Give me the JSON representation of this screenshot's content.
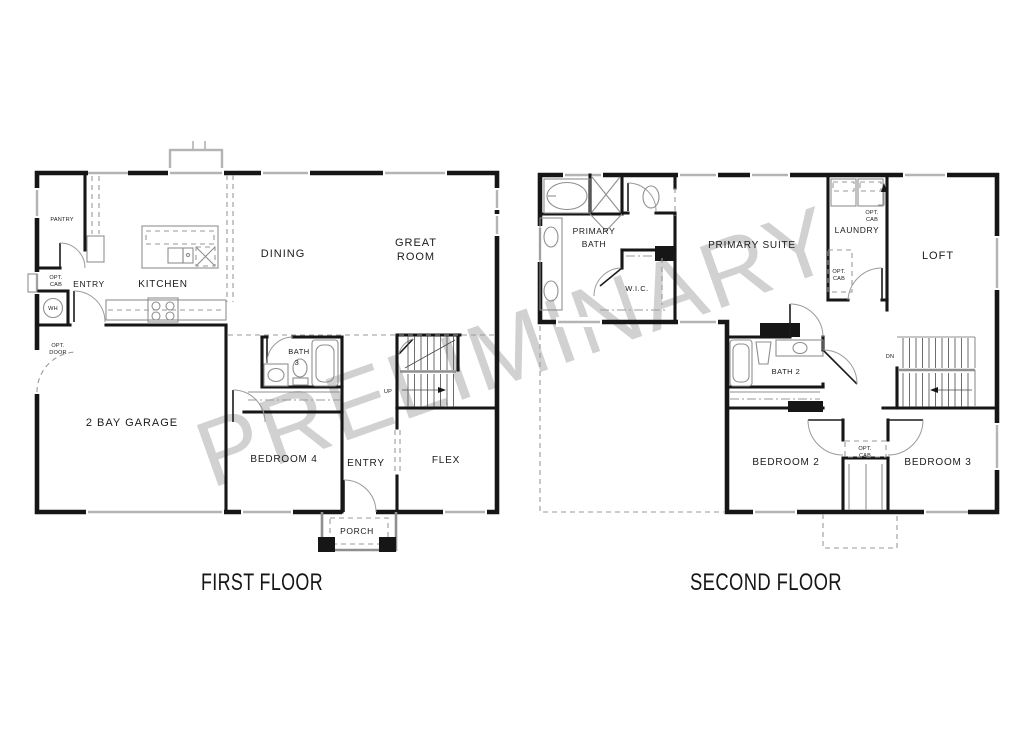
{
  "watermark": "PRELIMINARY",
  "colors": {
    "background": "#ffffff",
    "wall": "#161616",
    "fixture": "#8f8f8f",
    "dashed": "#9a9a9a",
    "window_sill": "#b4b4b4",
    "watermark": "#c9c9c9"
  },
  "first_floor": {
    "title": "FIRST FLOOR",
    "labels": {
      "pantry": "PANTRY",
      "opt_cab_line1": "OPT.",
      "opt_cab_line2": "CAB",
      "entry_rear": "ENTRY",
      "wh": "WH",
      "kitchen": "KITCHEN",
      "dining": "DINING",
      "great_room_line1": "GREAT",
      "great_room_line2": "ROOM",
      "opt_door_line1": "OPT.",
      "opt_door_line2": "DOOR",
      "garage": "2 BAY GARAGE",
      "bath3_line1": "BATH",
      "bath3_line2": "3",
      "bedroom4": "BEDROOM 4",
      "entry_front": "ENTRY",
      "up": "UP",
      "flex": "FLEX",
      "porch": "PORCH"
    }
  },
  "second_floor": {
    "title": "SECOND FLOOR",
    "labels": {
      "primary_bath_line1": "PRIMARY",
      "primary_bath_line2": "BATH",
      "wic": "W.I.C.",
      "primary_suite": "PRIMARY SUITE",
      "laundry": "LAUNDRY",
      "opt_cab_laundry_line1": "OPT.",
      "opt_cab_laundry_line2": "CAB",
      "opt_cab_hall_line1": "OPT.",
      "opt_cab_hall_line2": "CAB",
      "loft": "LOFT",
      "dn": "DN",
      "bath2": "BATH 2",
      "bedroom2": "BEDROOM 2",
      "bedroom3": "BEDROOM 3",
      "opt_cab_bedroom_line1": "OPT.",
      "opt_cab_bedroom_line2": "CAB"
    }
  }
}
